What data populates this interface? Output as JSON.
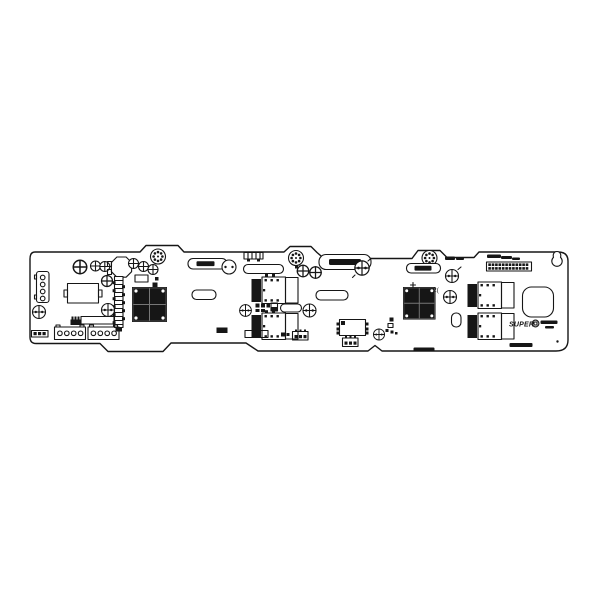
{
  "scene": {
    "background_color": "#ffffff",
    "ink_color": "#161616",
    "description": "Black-and-white technical top-view line drawing of a long SAS backplane PCB centered on a white page"
  },
  "board": {
    "logo_text": "SUPER",
    "ref_marking_text": "2("
  }
}
